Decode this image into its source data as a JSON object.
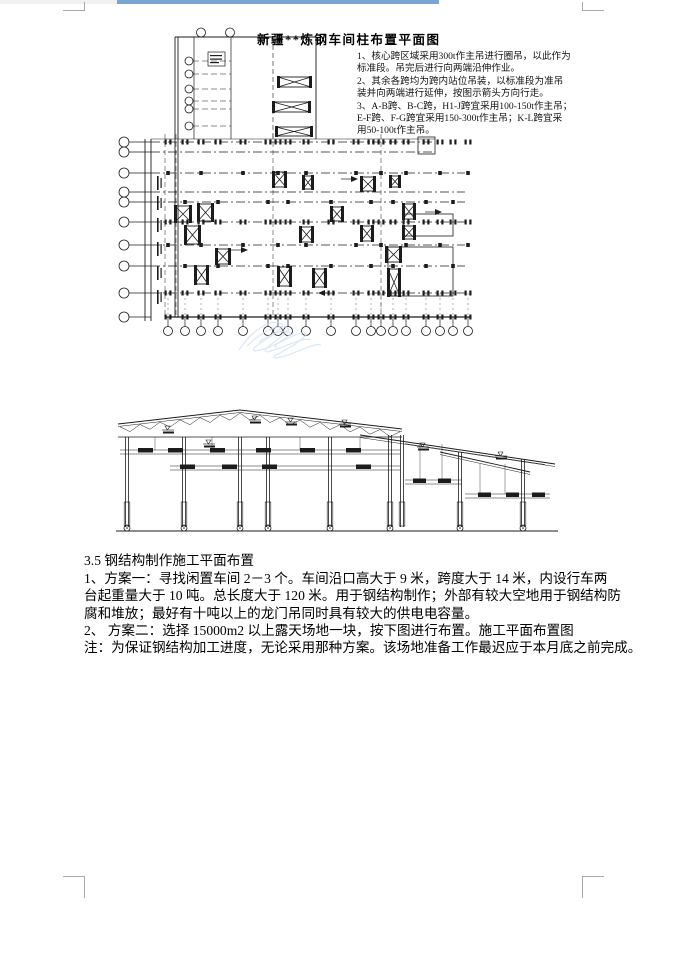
{
  "colors": {
    "top_strip_blue": "#7ba4d6",
    "top_strip_gray": "#f1f1f1",
    "crop_mark_gray": "#a9a9a9",
    "watermark_blue": "#cfe0f3",
    "drawing_line": "#1c1c1c"
  },
  "plan": {
    "title": "新疆**炼钢车间柱布置平面图",
    "notes": [
      "1、核心跨区域采用300t作主吊进行圈吊，以此作为",
      "标准段。吊完后进行向两端沿伸作业。",
      "2、其余各跨均为跨内站位吊装，以标准段为准吊",
      "装并向两端进行延伸，按图示箭头方向行走。",
      "3、A-B跨、B-C跨，H1-J跨宜采用100-150t作主吊；",
      "E-F跨、F-G跨宜采用150-300t作主吊；K-L跨宜采",
      "用50-100t作主吊。"
    ]
  },
  "body": {
    "heading": "3.5 钢结构制作施工平面布置",
    "lines": [
      "1、方案一：寻找闲置车间 2－3 个。车间沿口高大于 9 米，跨度大于 14 米，内设行车两",
      "台起重量大于 10 吨。总长度大于 120 米。用于钢结构制作；外部有较大空地用于钢结构防",
      "腐和堆放；最好有十吨以上的龙门吊同时具有较大的供电电容量。",
      "2、 方案二：选择 15000m2 以上露天场地一块，按下图进行布置。施工平面布置图",
      "注：为保证钢结构加工进度，无论采用那种方案。该场地准备工作最迟应于本月底之前完成。"
    ]
  }
}
